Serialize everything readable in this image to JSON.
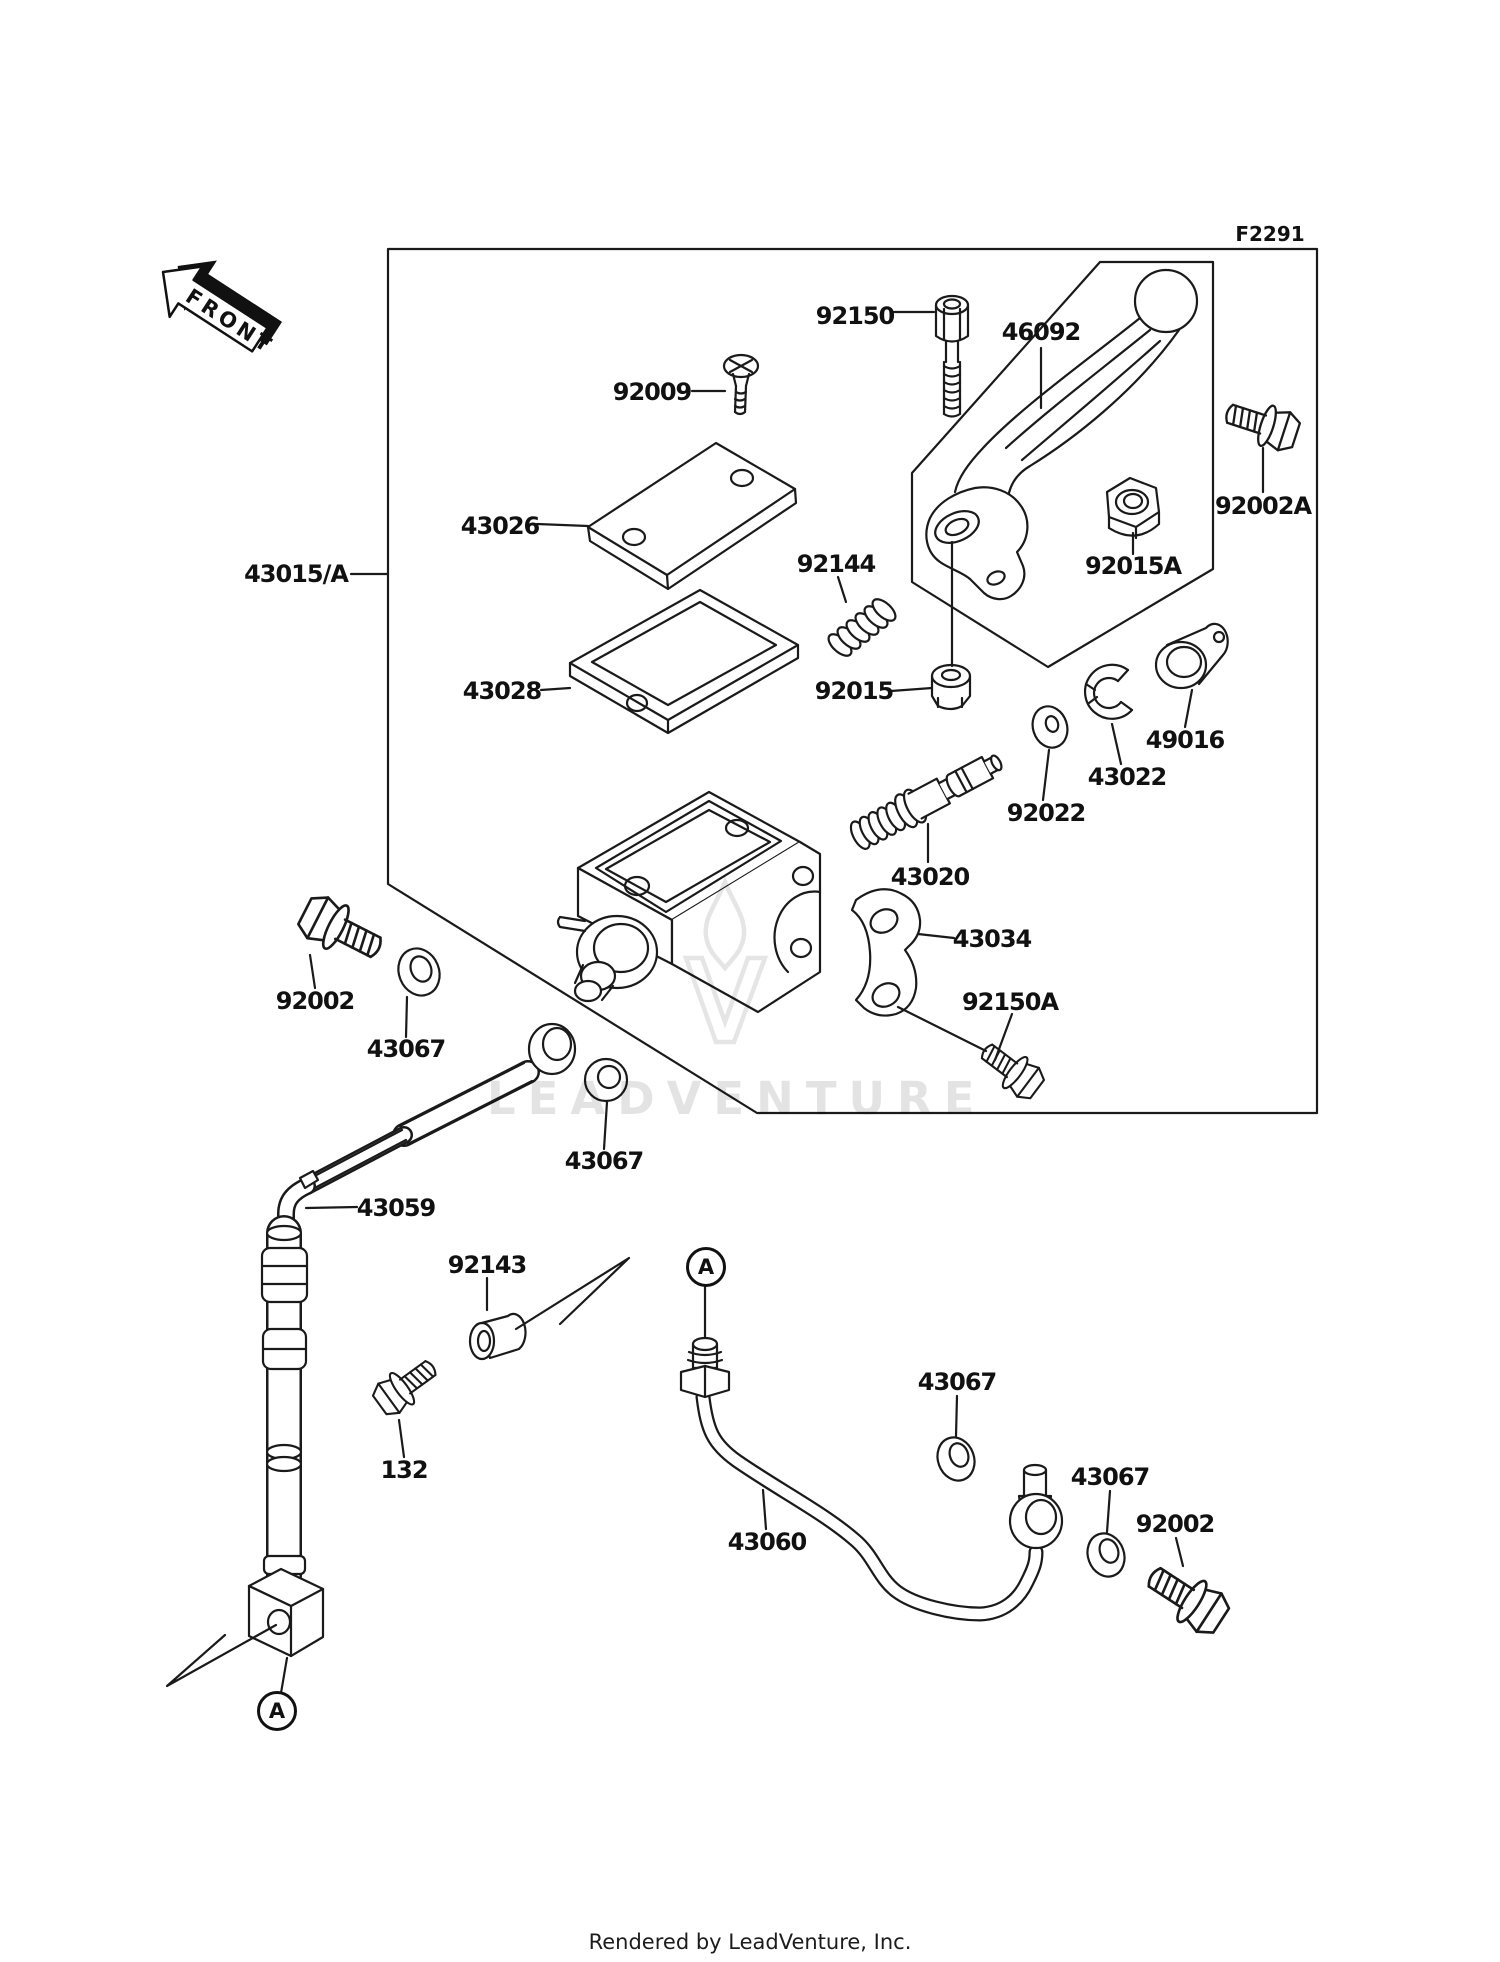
{
  "figure": {
    "code": "F2291",
    "direction_marker": "FRONT"
  },
  "labels": {
    "front": "FRONT",
    "f2291": "F2291",
    "p92150": "92150",
    "p46092": "46092",
    "p92009": "92009",
    "p92002a": "92002A",
    "p43026": "43026",
    "p43015a": "43015/A",
    "p92144": "92144",
    "p92015a": "92015A",
    "p43028": "43028",
    "p92015": "92015",
    "p49016": "49016",
    "p43022": "43022",
    "p92022": "92022",
    "p43020": "43020",
    "p43034": "43034",
    "p92150a": "92150A",
    "p92002_left": "92002",
    "p43067_1": "43067",
    "p43067_2": "43067",
    "p43059": "43059",
    "p92143": "92143",
    "p132": "132",
    "p43067_3": "43067",
    "p43060": "43060",
    "p43067_4": "43067",
    "p92002_right": "92002",
    "a_top": "A",
    "a_bottom": "A"
  },
  "watermark": {
    "text": "LEADVENTURE"
  },
  "footer": {
    "credit": "Rendered by LeadVenture, Inc."
  },
  "colors": {
    "line": "#1a1a1a",
    "label": "#111111",
    "watermark": "#e0e0e0",
    "background": "#ffffff"
  }
}
